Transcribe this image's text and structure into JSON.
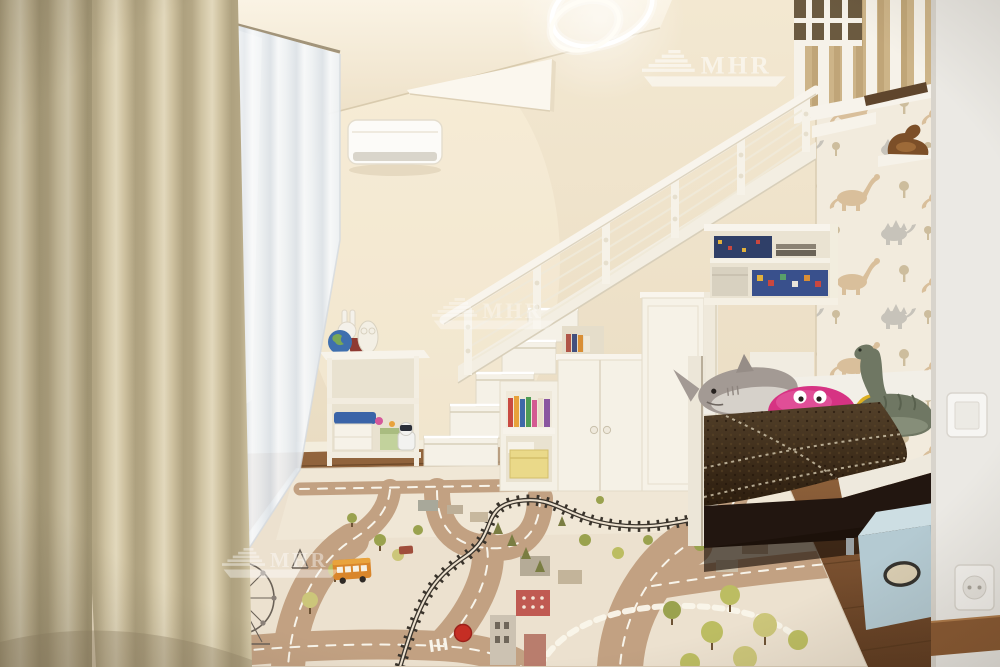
{
  "meta": {
    "type": "interior-photograph",
    "room": "children's loft bedroom with staircase storage and play rug",
    "width_px": 1000,
    "height_px": 667
  },
  "watermark": {
    "text": "MHR",
    "count": 3,
    "color": "#ffffff"
  },
  "rug": {
    "park_label": "ПАРК",
    "style": "city road play rug",
    "base_color": "#ece1cf",
    "road_color": "#c2a182",
    "features": [
      "roads with white dashed lane lines",
      "black railway with sleepers",
      "ferris wheel",
      "park sign",
      "orange bus",
      "red traffic dot",
      "houses and towers",
      "olive and yellow-green trees",
      "dashed pedestrian path"
    ]
  },
  "objects": {
    "lighting": {
      "name": "ring-pendant-light",
      "color": "#ffffff"
    },
    "climate": {
      "name": "air-conditioner",
      "color": "#fbfaf7"
    },
    "curtains": {
      "blackout_color": "#c9bc9c",
      "sheer_color": "#eef1f4"
    },
    "staircase": {
      "color": "#f5f1e7",
      "railing": "white posts with cable infill"
    },
    "wallpaper": {
      "pattern": "dinosaurs",
      "colors": [
        "#d9bf9b",
        "#c7c3ba",
        "#f2ebdd"
      ]
    },
    "bed": {
      "base_color": "#221610",
      "blanket_color": "#3f2d18",
      "mattress_color": "#f2efe7"
    },
    "plush_toys": [
      "gray shark",
      "pink crab",
      "yellow ball",
      "green dinosaur"
    ],
    "shelf_toys": [
      "bunny lamp",
      "globe",
      "red box",
      "owl figure",
      "robot dog",
      "pencil case",
      "storage boxes"
    ],
    "storage": {
      "under_stair_cabinets": "white",
      "toy_shelf": "white",
      "fabric_box_color": "#b4cad2"
    },
    "floor": {
      "material": "wood",
      "color": "#7a5130"
    },
    "electrical": [
      "light-switch",
      "power-socket"
    ]
  },
  "palette": {
    "wall": "#ecdfc6",
    "ceiling": "#f8f0df",
    "accent_pink": "#d63383",
    "accent_blue": "#3a64a8",
    "accent_yellow": "#e5b321"
  }
}
